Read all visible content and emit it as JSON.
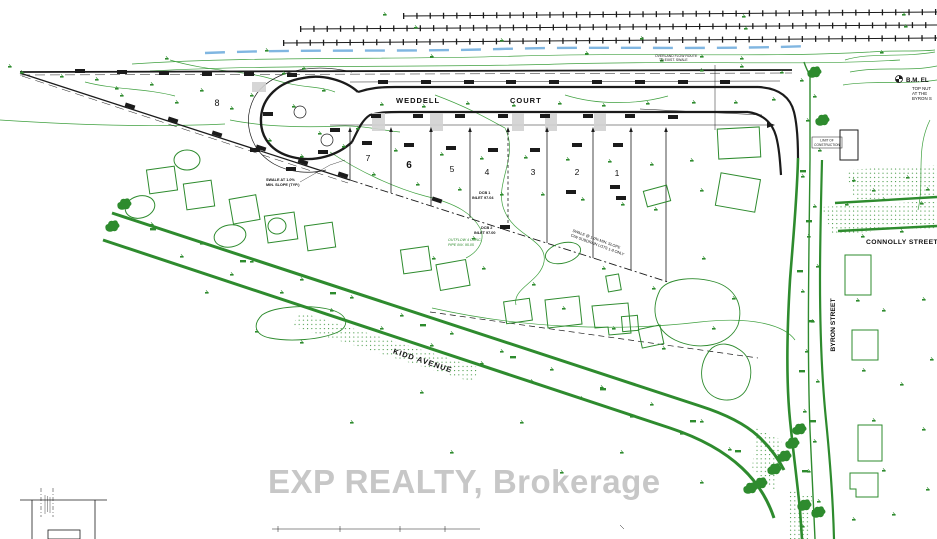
{
  "plan": {
    "streets": {
      "weddell_left": "WEDDELL",
      "weddell_right": "COURT",
      "connolly": "CONNOLLY STREET",
      "byron": "BYRON STREET",
      "kidd": "KIDD AVENUE"
    },
    "lots": [
      {
        "label": "8"
      },
      {
        "label": "7"
      },
      {
        "label": "6"
      },
      {
        "label": "5"
      },
      {
        "label": "4"
      },
      {
        "label": "3"
      },
      {
        "label": "2"
      },
      {
        "label": "1"
      }
    ],
    "benchmark": {
      "title": "B.M. EL",
      "l1": "TOP NUT",
      "l2": "AT THE",
      "l3": "BYRON S"
    },
    "annotations": {
      "swale_typ_1": "SWALE AT 1.0%",
      "swale_typ_2": "MIN. SLOPE (TYP.)",
      "dcb1_1": "DCB 1",
      "dcb1_2": "INLET 97.04",
      "dcb2_1": "DCB 2",
      "dcb2_2": "INLET 97.00",
      "outflow_1": "OUTFLOW 4 CONC.",
      "outflow_2": "PIPE INV. 95.05",
      "subdrain_1": "SWALE @ 1.0% MIN. SLOPE",
      "subdrain_2": "C/W SUBDRAIN LOTS 1-8 ONLY",
      "overland_1": "OVERLAND FLOW ROUTE",
      "overland_2": "TO EXIST. SWALE",
      "limit_1": "LIMIT OF",
      "limit_2": "CONSTRUCTION"
    },
    "watermark": "EXP REALTY, Brokerage"
  },
  "colors": {
    "line_green": "#2e8b2e",
    "line_black": "#1b1b1b",
    "stream_blue": "#72aede",
    "hatch_gray": "#d2d2d2",
    "watermark_gray": "#c7c7c7"
  }
}
